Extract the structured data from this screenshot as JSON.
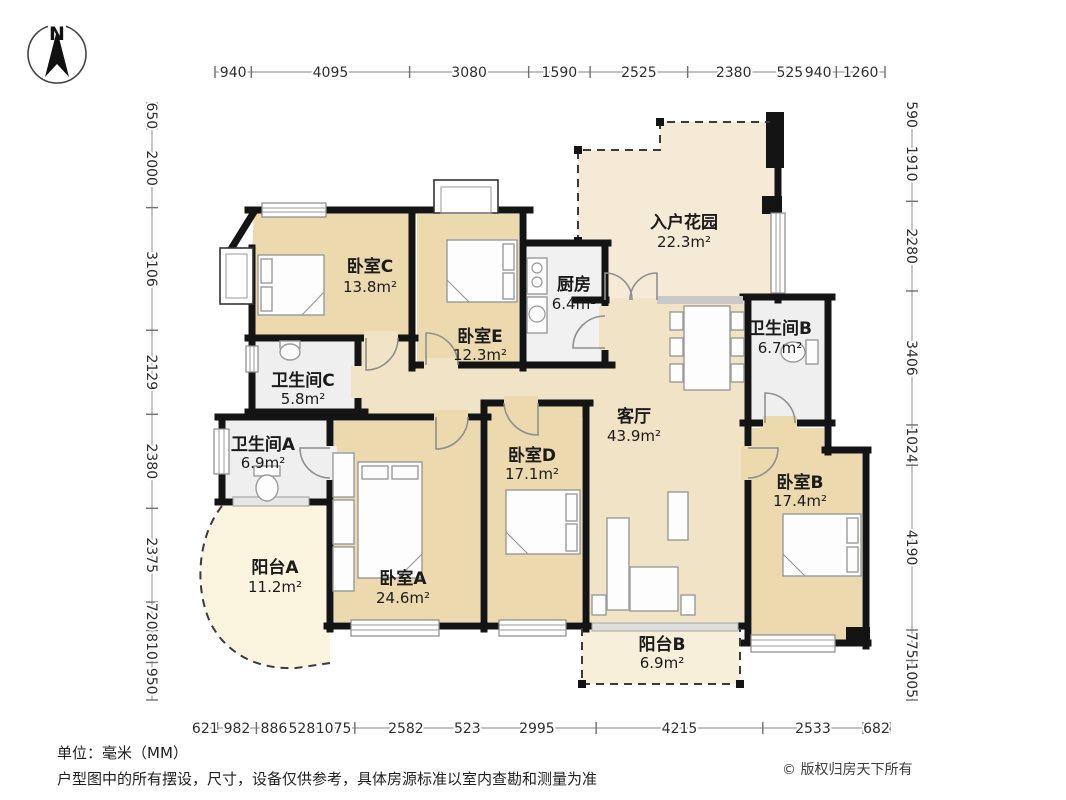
{
  "compass": {
    "label": "N"
  },
  "rooms": [
    {
      "name": "卧室C",
      "area": "13.8m²"
    },
    {
      "name": "卧室E",
      "area": "12.3m²"
    },
    {
      "name": "厨房",
      "area": "6.4m²"
    },
    {
      "name": "入户花园",
      "area": "22.3m²"
    },
    {
      "name": "卫生间B",
      "area": "6.7m²"
    },
    {
      "name": "卫生间C",
      "area": "5.8m²"
    },
    {
      "name": "卫生间A",
      "area": "6.9m²"
    },
    {
      "name": "客厅",
      "area": "43.9m²"
    },
    {
      "name": "卧室D",
      "area": "17.1m²"
    },
    {
      "name": "卧室B",
      "area": "17.4m²"
    },
    {
      "name": "阳台A",
      "area": "11.2m²"
    },
    {
      "name": "卧室A",
      "area": "24.6m²"
    },
    {
      "name": "阳台B",
      "area": "6.9m²"
    }
  ],
  "dimensions": {
    "top": [
      "940",
      "4095",
      "3080",
      "1590",
      "2525",
      "2380",
      "525",
      "940",
      "1260"
    ],
    "left": [
      "650",
      "2000",
      "3106",
      "2129",
      "2380",
      "2375",
      "720",
      "810",
      "950"
    ],
    "right": [
      "590",
      "1910",
      "2280",
      "3406",
      "1024",
      "4190",
      "775",
      "1005"
    ],
    "bottom": [
      "621",
      "982",
      "886",
      "528",
      "1075",
      "2582",
      "523",
      "2995",
      "4215",
      "2533",
      "682"
    ]
  },
  "footer": {
    "unit_note": "单位：毫米（MM）",
    "disclaimer": "户型图中的所有摆设，尺寸，设备仅供参考，具体房源标准以室内查勘和测量为准",
    "copyright": "© 版权归房天下所有"
  },
  "colors": {
    "wall": "#141414",
    "bedroom_fill": "#ecd9ae",
    "living_fill": "#f1e3c6",
    "garden_fill": "#f5ead6",
    "balcony_fill": "#fbf5e0",
    "bath_fill": "#efefef"
  }
}
